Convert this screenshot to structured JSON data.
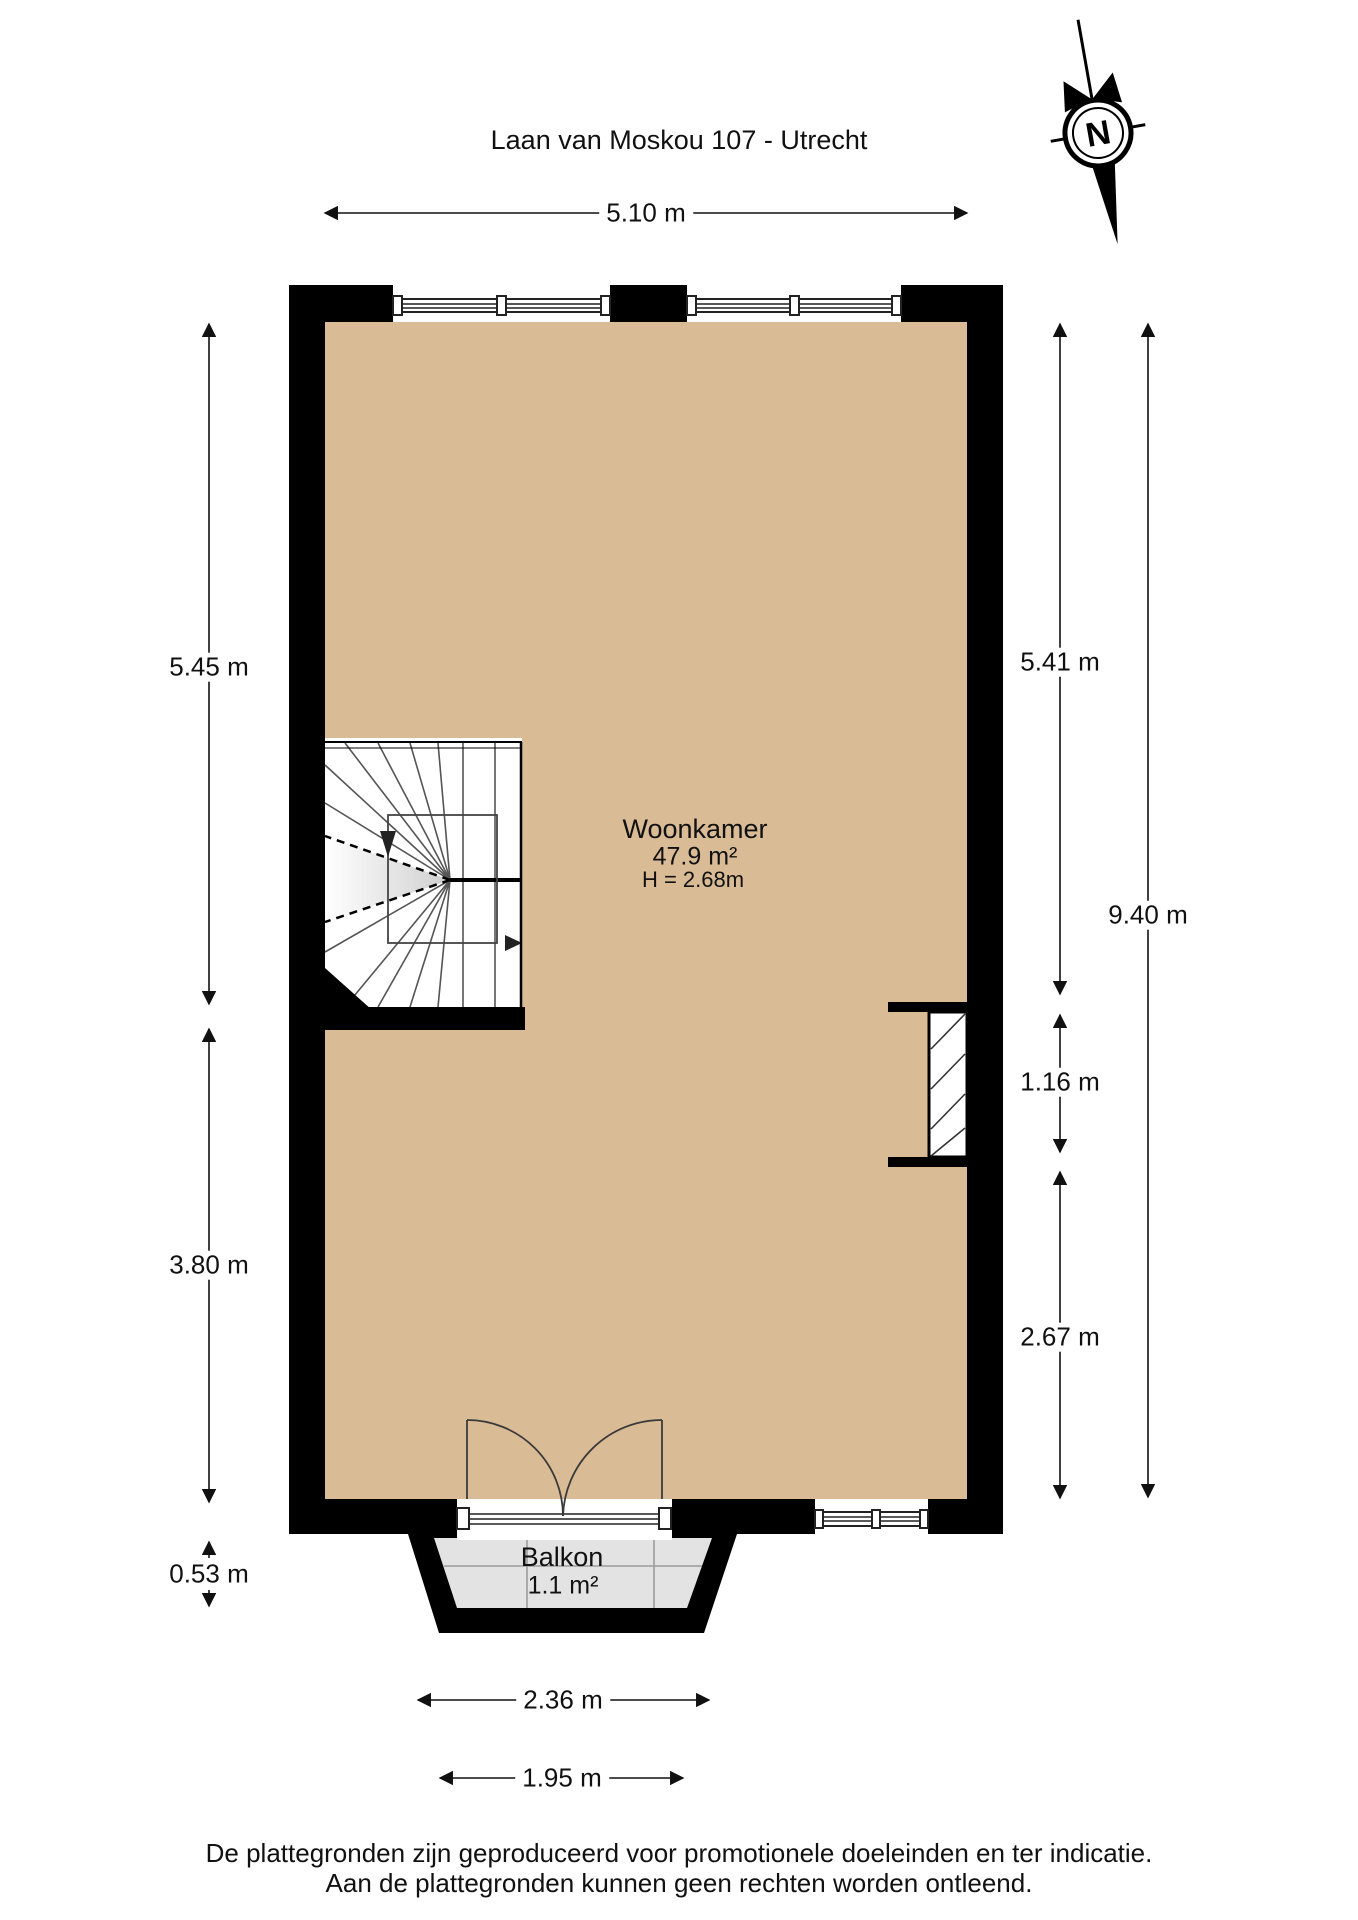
{
  "title": "Laan van Moskou 107 - Utrecht",
  "compass": {
    "label": "N"
  },
  "rooms": {
    "woonkamer": {
      "name": "Woonkamer",
      "area": "47.9 m²",
      "ceiling": "H = 2.68m"
    },
    "balkon": {
      "name": "Balkon",
      "area": "1.1 m²"
    }
  },
  "dimensions": {
    "top_width": "5.10 m",
    "left_upper": "5.45 m",
    "left_lower": "3.80 m",
    "left_balcony_depth": "0.53 m",
    "right_upper": "5.41 m",
    "right_total": "9.40 m",
    "right_niche": "1.16 m",
    "right_lower": "2.67 m",
    "balcony_outer_width": "2.36 m",
    "balcony_inner_width": "1.95 m"
  },
  "footer": {
    "line1": "De plattegronden zijn geproduceerd voor promotionele doeleinden en ter indicatie.",
    "line2": "Aan de plattegronden kunnen geen rechten worden ontleend."
  },
  "colors": {
    "floor": "#d9bb96",
    "balcony_floor": "#e3e3e3",
    "wall": "#000000",
    "line": "#333333"
  }
}
